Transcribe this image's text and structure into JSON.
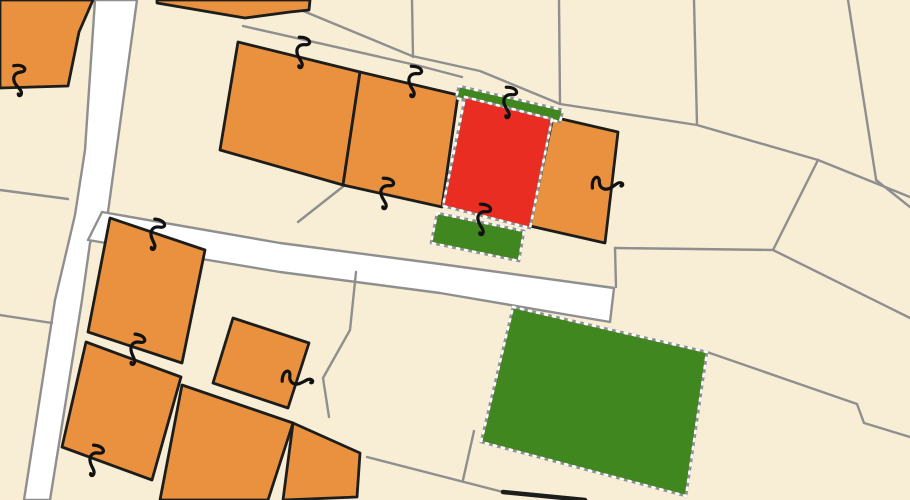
{
  "map": {
    "kind": "cadastral-parcel-map",
    "canvas": {
      "width": 910,
      "height": 500
    },
    "colors": {
      "parcel_fill": "#F8EDD5",
      "road_fill": "#FFFFFF",
      "boundary_gray": "#8F8F8F",
      "building_fill": "#E9913E",
      "building_outline": "#1D1D1B",
      "selected_red": "#EA2D22",
      "selected_green": "#41871F",
      "marquee_dash": "#FFFFFF",
      "glyph_black": "#111111"
    },
    "glyph_path": "M -14 5 C -17 -6, -9 -10, -8 -2 C -7 4, -2 6, 3 3 C 8 0, 10 -5, 14 -4 C 16 -3.5, 16 -1, 14 -1",
    "layers": [
      {
        "name": "road-vertical",
        "type": "polygon",
        "role": "road",
        "points": "95,0 137,0 108,212 90,243 82,300 50,500 24,500 55,300 75,215 85,150"
      },
      {
        "name": "road-diagonal",
        "type": "polygon",
        "role": "road",
        "points": "102,212 280,243 440,264 614,288 610,322 440,293 280,272 88,240"
      },
      {
        "name": "boundary-left-upper",
        "type": "polyline",
        "role": "boundary",
        "points": "0,190 68,199"
      },
      {
        "name": "boundary-left-lower",
        "type": "polyline",
        "role": "boundary",
        "points": "0,315 52,323"
      },
      {
        "name": "boundary-top-v1",
        "type": "polyline",
        "role": "boundary",
        "points": "412,0 413,57"
      },
      {
        "name": "boundary-top-v2",
        "type": "polyline",
        "role": "boundary",
        "points": "559,0 560,104"
      },
      {
        "name": "boundary-top-v3",
        "type": "polyline",
        "role": "boundary",
        "points": "694,0 697,124"
      },
      {
        "name": "boundary-top-right",
        "type": "polyline",
        "role": "boundary",
        "points": "848,0 876,179"
      },
      {
        "name": "path-band-upper",
        "type": "polyline",
        "role": "boundary",
        "points": "296,8 412,56 480,71 560,104 697,125 818,160 910,197"
      },
      {
        "name": "path-band-lower",
        "type": "polyline",
        "role": "boundary",
        "points": "243,26 420,66 462,77"
      },
      {
        "name": "path-band-lower-right",
        "type": "polyline",
        "role": "boundary",
        "points": "876,180 910,207"
      },
      {
        "name": "boundary-se-1",
        "type": "polyline",
        "role": "boundary",
        "points": "818,160 773,250"
      },
      {
        "name": "boundary-se-2",
        "type": "polyline",
        "role": "boundary",
        "points": "615,248 773,250"
      },
      {
        "name": "boundary-se-3",
        "type": "polyline",
        "role": "boundary",
        "points": "773,250 910,318"
      },
      {
        "name": "boundary-se-notch",
        "type": "polyline",
        "role": "boundary",
        "points": "707,352 857,404 864,423 910,437"
      },
      {
        "name": "boundary-road-end",
        "type": "polyline",
        "role": "boundary",
        "points": "615,248 616,287"
      },
      {
        "name": "boundary-green-foot",
        "type": "polyline",
        "role": "boundary",
        "points": "474,431 463,480"
      },
      {
        "name": "boundary-bottom-long",
        "type": "polyline",
        "role": "boundary",
        "points": "367,457 503,492"
      },
      {
        "name": "boundary-row-foot",
        "type": "polyline",
        "role": "boundary",
        "points": "298,222 345,185"
      },
      {
        "name": "boundary-mid-cluster",
        "type": "polyline",
        "role": "boundary",
        "points": "356,272 350,330 323,378 329,417"
      },
      {
        "name": "building-top-left",
        "type": "polygon",
        "role": "building",
        "points": "0,0 93,0 79,32 68,86 0,88"
      },
      {
        "name": "building-top-strip",
        "type": "polygon",
        "role": "building",
        "points": "157,0 310,0 309,10 290,12 245,18 157,3"
      },
      {
        "name": "building-row-a",
        "type": "polygon",
        "role": "building",
        "points": "238,42 360,72 343,185 220,150"
      },
      {
        "name": "building-row-b",
        "type": "polygon",
        "role": "building",
        "points": "360,72 458,95 442,207 343,185"
      },
      {
        "name": "building-row-c",
        "type": "polygon",
        "role": "building",
        "points": "553,117 618,132 605,243 530,226"
      },
      {
        "name": "building-sw-1",
        "type": "polygon",
        "role": "building",
        "points": "110,218 205,250 182,363 88,332"
      },
      {
        "name": "building-sw-2",
        "type": "polygon",
        "role": "building",
        "points": "86,342 181,377 152,480 62,447"
      },
      {
        "name": "building-sw-3",
        "type": "polygon",
        "role": "building",
        "points": "233,318 309,343 288,408 213,383"
      },
      {
        "name": "building-sw-4",
        "type": "polygon",
        "role": "building",
        "points": "182,385 293,423 268,500 160,500"
      },
      {
        "name": "building-sw-5",
        "type": "polygon",
        "role": "building",
        "points": "293,423 360,453 357,497 283,500"
      },
      {
        "name": "selected-parcel-green-strip",
        "type": "polygon",
        "role": "selected-green",
        "points": "459,86 563,110 560,122 456,98"
      },
      {
        "name": "selected-parcel-red",
        "type": "polygon",
        "role": "selected-red",
        "points": "465,97 552,119 530,228 443,206"
      },
      {
        "name": "selected-parcel-green-small",
        "type": "polygon",
        "role": "selected-green",
        "points": "437,213 524,231 519,261 431,243"
      },
      {
        "name": "selected-parcel-green-large",
        "type": "polygon",
        "role": "selected-green",
        "points": "513,307 707,352 686,496 481,442"
      },
      {
        "name": "building-edge-bottom",
        "type": "polyline",
        "role": "building-edge",
        "points": "503,492 585,500"
      },
      {
        "name": "survey-mark",
        "type": "glyph",
        "x": 18,
        "y": 80,
        "rot": 93
      },
      {
        "name": "survey-mark",
        "type": "glyph",
        "x": 301,
        "y": 52,
        "rot": 103
      },
      {
        "name": "survey-mark",
        "type": "glyph",
        "x": 413,
        "y": 81,
        "rot": 103
      },
      {
        "name": "survey-mark",
        "type": "glyph",
        "x": 385,
        "y": 193,
        "rot": 103
      },
      {
        "name": "survey-mark",
        "type": "glyph",
        "x": 508,
        "y": 102,
        "rot": 103
      },
      {
        "name": "survey-mark",
        "type": "glyph",
        "x": 482,
        "y": 219,
        "rot": 103
      },
      {
        "name": "survey-mark",
        "type": "glyph",
        "x": 607,
        "y": 185,
        "rot": 8
      },
      {
        "name": "survey-mark",
        "type": "glyph",
        "x": 155,
        "y": 234,
        "rot": 109
      },
      {
        "name": "survey-mark",
        "type": "glyph",
        "x": 135,
        "y": 349,
        "rot": 110
      },
      {
        "name": "survey-mark",
        "type": "glyph",
        "x": 94,
        "y": 460,
        "rot": 108
      },
      {
        "name": "survey-mark",
        "type": "glyph",
        "x": 297,
        "y": 380,
        "rot": 15
      }
    ]
  }
}
